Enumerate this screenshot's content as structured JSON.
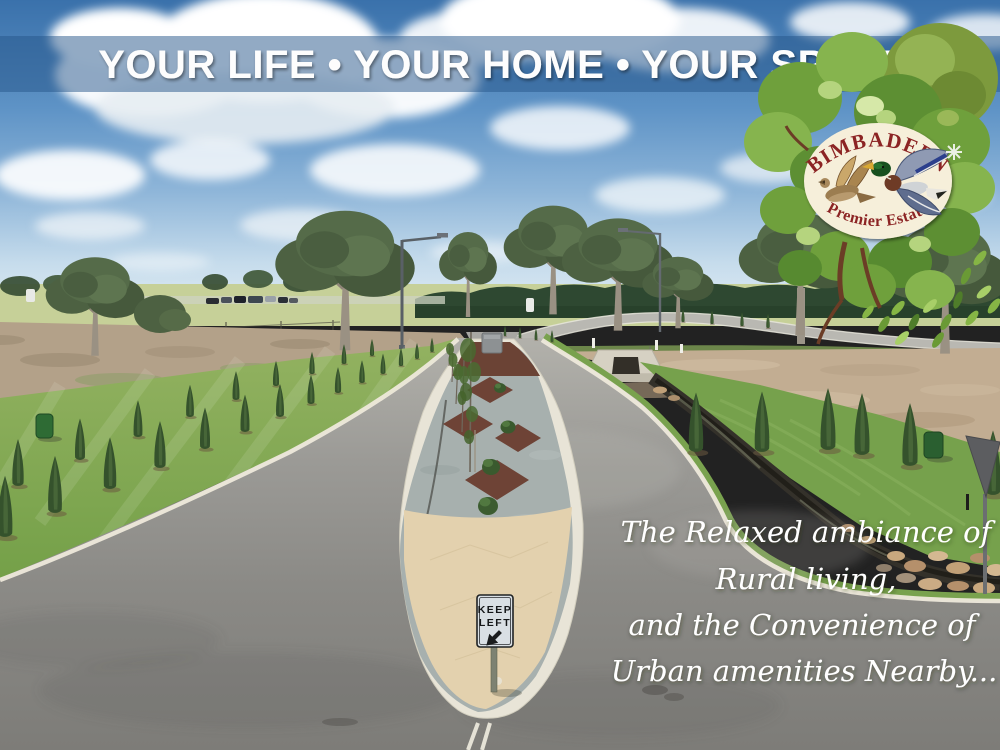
{
  "banner": {
    "text": "YOUR LIFE • YOUR HOME • YOUR SPACE"
  },
  "logo": {
    "name": "BIMBADEEN",
    "tagline": "Premier Estate"
  },
  "keep_left_sign": {
    "line1": "KEEP",
    "line2": "LEFT"
  },
  "quote": {
    "lines": [
      "The Relaxed ambiance of",
      "Rural living,",
      "and the Convenience of",
      "Urban amenities Nearby..."
    ]
  },
  "icons": {
    "logo_tree": "tree-canopy-icon",
    "hen_duck": "hen-duck-icon",
    "drake_duck": "drake-duck-icon",
    "sparkle": "sparkle-icon",
    "keep_left_arrow": "down-left-arrow-icon"
  },
  "colors": {
    "banner_blue": "rgba(38,86,138,0.5)",
    "logo_red": "#8c2424",
    "logo_cream": "#f6efda",
    "sky_top": "#3a71ab",
    "asphalt": "#8b8a87",
    "lawn_green": "#7fa850",
    "median_gravel": "#a7b0ae",
    "mulch_red": "#6b4335",
    "tip_concrete": "#e3d1ae"
  }
}
